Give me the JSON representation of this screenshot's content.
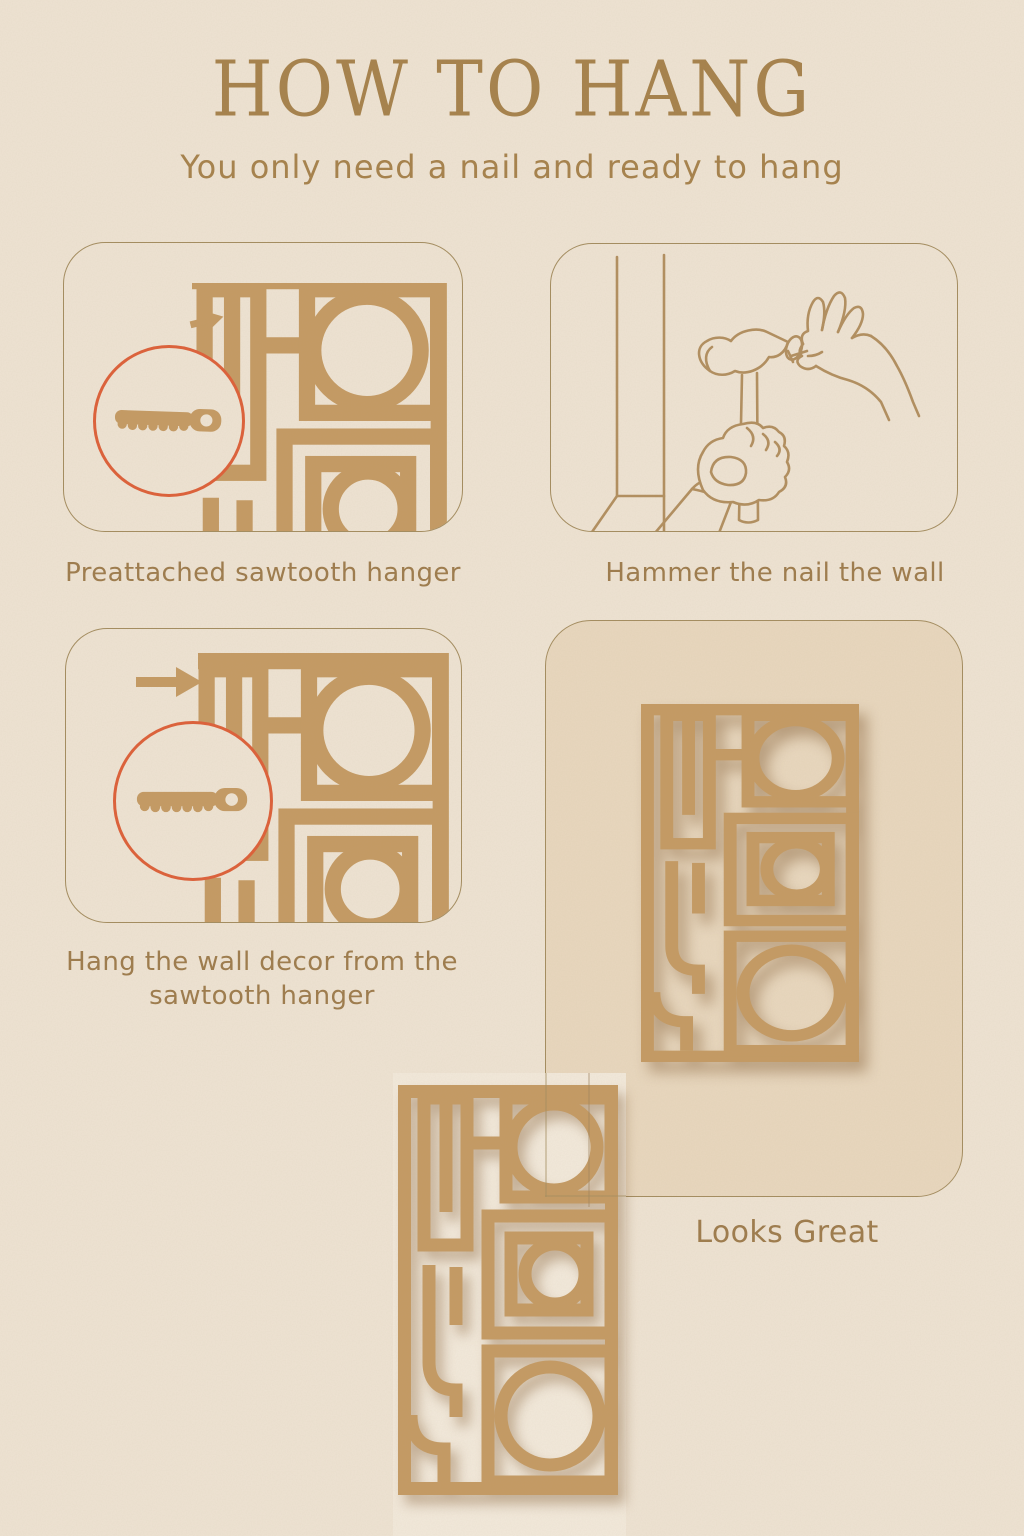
{
  "page": {
    "title": "HOW TO HANG",
    "subtitle": "You only need a nail and ready to hang"
  },
  "steps": [
    {
      "caption": "Preattached sawtooth hanger"
    },
    {
      "caption": "Hammer the nail the wall"
    },
    {
      "caption": "Hang the wall decor from the sawtooth hanger"
    },
    {
      "caption": "Looks Great"
    }
  ],
  "icons": {
    "sawtooth_hanger": "sawtooth-hanger-icon",
    "magnifier_circle": "zoom-highlight-circle",
    "arrow_small": "right-arrow-icon",
    "arrow_large": "right-arrow-icon",
    "hammer": "hammer-icon",
    "nail_hand": "hand-holding-nail-icon",
    "wall_decor": "geometric-wall-decor-graphic"
  },
  "colors": {
    "background": "#eee3d3",
    "decor_tan": "#c49a63",
    "panel_outline": "#a38c5f",
    "text": "#9d7b4c",
    "title": "#a5814b",
    "highlight_circle_red": "#dd5f38",
    "panel4_fill": "#e8d7be",
    "photo_background": "#f2e9db",
    "line_art": "#b18e5f"
  }
}
